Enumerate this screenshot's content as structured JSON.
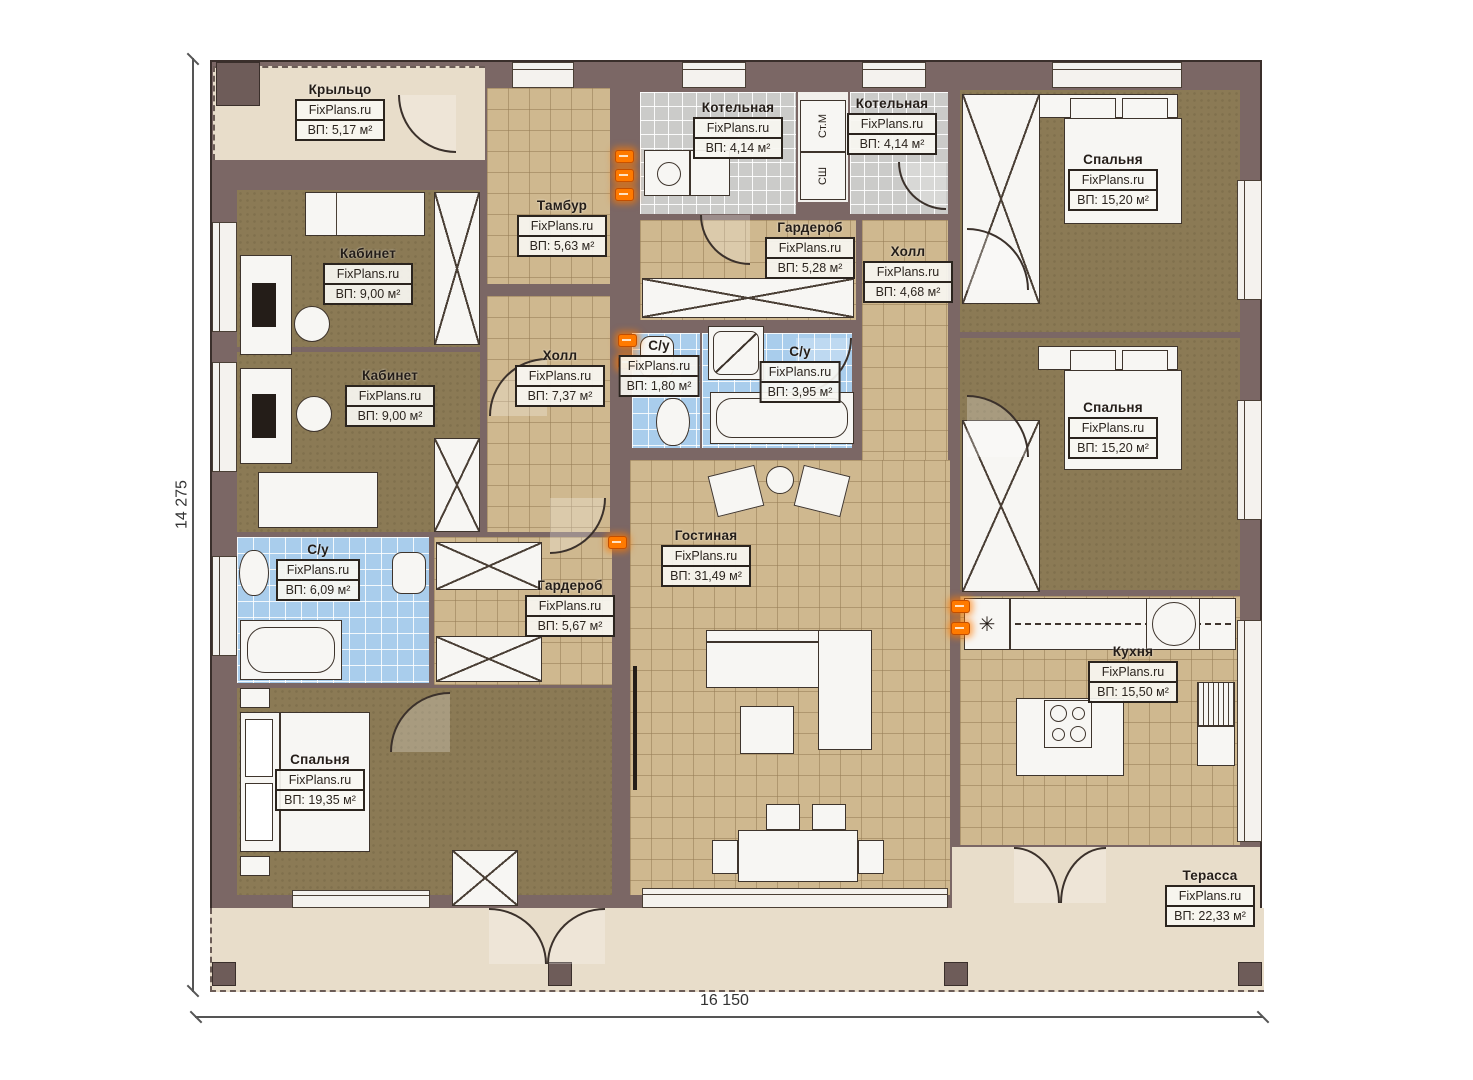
{
  "plan_title": "floor-plan",
  "dimensions": {
    "horizontal": "16 150",
    "vertical": "14 275"
  },
  "closet": {
    "top_label": "Ст.М",
    "bottom_label": "СШ"
  },
  "colors": {
    "wall": "#7b6765",
    "tile_tan": "#cfb88f",
    "floor_brown": "#8b7a55",
    "tile_blue": "#a9cdec",
    "tile_gray": "#cbcbc9",
    "terrace": "#e8ddca",
    "radiator_accent": "#ff7a00"
  },
  "rooms": [
    {
      "id": "porch",
      "name": "Крыльцо",
      "watermark": "FixPlans.ru",
      "area": "ВП: 5,17 м²"
    },
    {
      "id": "boiler-1",
      "name": "Котельная",
      "watermark": "FixPlans.ru",
      "area": "ВП: 4,14 м²"
    },
    {
      "id": "boiler-2",
      "name": "Котельная",
      "watermark": "FixPlans.ru",
      "area": "ВП: 4,14 м²"
    },
    {
      "id": "bedroom-tr",
      "name": "Спальня",
      "watermark": "FixPlans.ru",
      "area": "ВП: 15,20 м²"
    },
    {
      "id": "office-1",
      "name": "Кабинет",
      "watermark": "FixPlans.ru",
      "area": "ВП: 9,00 м²"
    },
    {
      "id": "tambour",
      "name": "Тамбур",
      "watermark": "FixPlans.ru",
      "area": "ВП: 5,63 м²"
    },
    {
      "id": "wardrobe-1",
      "name": "Гардероб",
      "watermark": "FixPlans.ru",
      "area": "ВП: 5,28 м²"
    },
    {
      "id": "hall-small",
      "name": "Холл",
      "watermark": "FixPlans.ru",
      "area": "ВП: 4,68 м²"
    },
    {
      "id": "office-2",
      "name": "Кабинет",
      "watermark": "FixPlans.ru",
      "area": "ВП: 9,00 м²"
    },
    {
      "id": "hall-main",
      "name": "Холл",
      "watermark": "FixPlans.ru",
      "area": "ВП: 7,37 м²"
    },
    {
      "id": "wc-1",
      "name": "С/у",
      "watermark": "FixPlans.ru",
      "area": "ВП: 1,80 м²"
    },
    {
      "id": "wc-2",
      "name": "С/у",
      "watermark": "FixPlans.ru",
      "area": "ВП: 3,95 м²"
    },
    {
      "id": "bedroom-mr",
      "name": "Спальня",
      "watermark": "FixPlans.ru",
      "area": "ВП: 15,20 м²"
    },
    {
      "id": "living",
      "name": "Гостиная",
      "watermark": "FixPlans.ru",
      "area": "ВП: 31,49 м²"
    },
    {
      "id": "wc-3",
      "name": "С/у",
      "watermark": "FixPlans.ru",
      "area": "ВП: 6,09 м²"
    },
    {
      "id": "wardrobe-2",
      "name": "Гардероб",
      "watermark": "FixPlans.ru",
      "area": "ВП: 5,67 м²"
    },
    {
      "id": "bedroom-bl",
      "name": "Спальня",
      "watermark": "FixPlans.ru",
      "area": "ВП: 19,35 м²"
    },
    {
      "id": "kitchen",
      "name": "Кухня",
      "watermark": "FixPlans.ru",
      "area": "ВП: 15,50 м²"
    },
    {
      "id": "terrace",
      "name": "Терасса",
      "watermark": "FixPlans.ru",
      "area": "ВП: 22,33 м²"
    }
  ]
}
